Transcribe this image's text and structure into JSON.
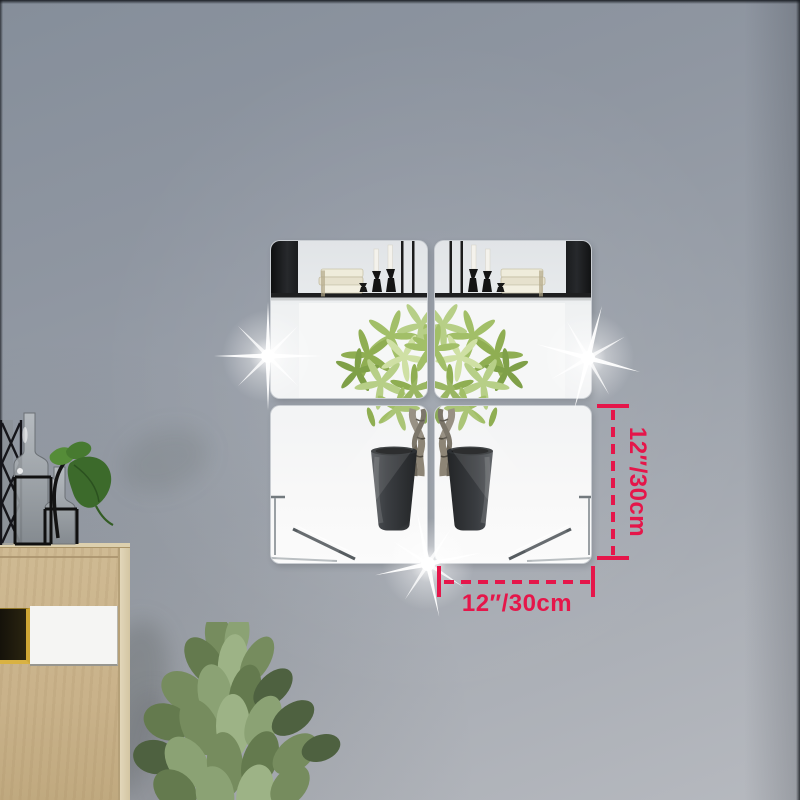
{
  "annotations": {
    "height_label": "12″/30cm",
    "width_label": "12″/30cm"
  },
  "palette": {
    "accent": "#e5164a",
    "wall-top": "#858e9a",
    "wall-bottom": "#b6b9bf",
    "mirror-black": "#17181a",
    "wood": "#c9b28a",
    "gold-trim": "#d9b242",
    "pot-charcoal": "#34373b",
    "money-tree-green": "#a2bf68",
    "fiddle-green": "#768c5e"
  },
  "objects": {
    "mirror_tile_count": 4,
    "sparkle_count": 3
  }
}
